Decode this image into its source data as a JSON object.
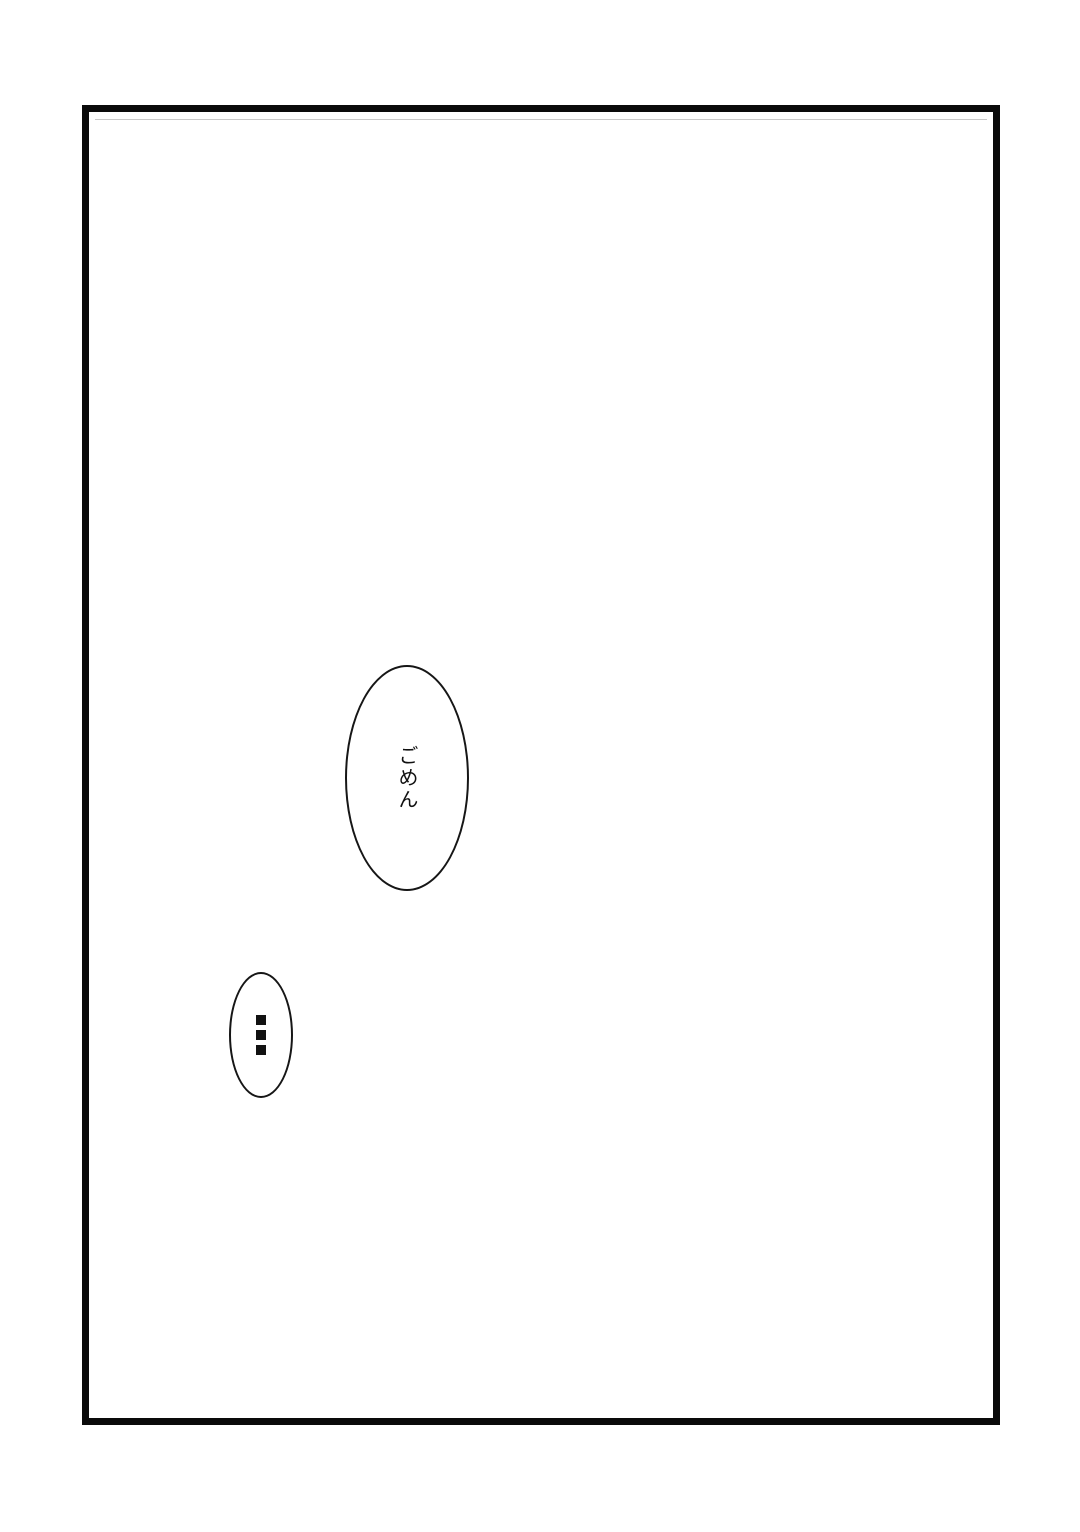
{
  "page": {
    "background_color": "#ffffff",
    "panel_border_color": "#0a0a0a",
    "ink_color": "#111111"
  },
  "bubbles": {
    "large": {
      "text": "ごめん",
      "shape": "ellipse"
    },
    "small": {
      "text": "…",
      "icon": "vertical-ellipsis-icon",
      "shape": "ellipse"
    }
  }
}
